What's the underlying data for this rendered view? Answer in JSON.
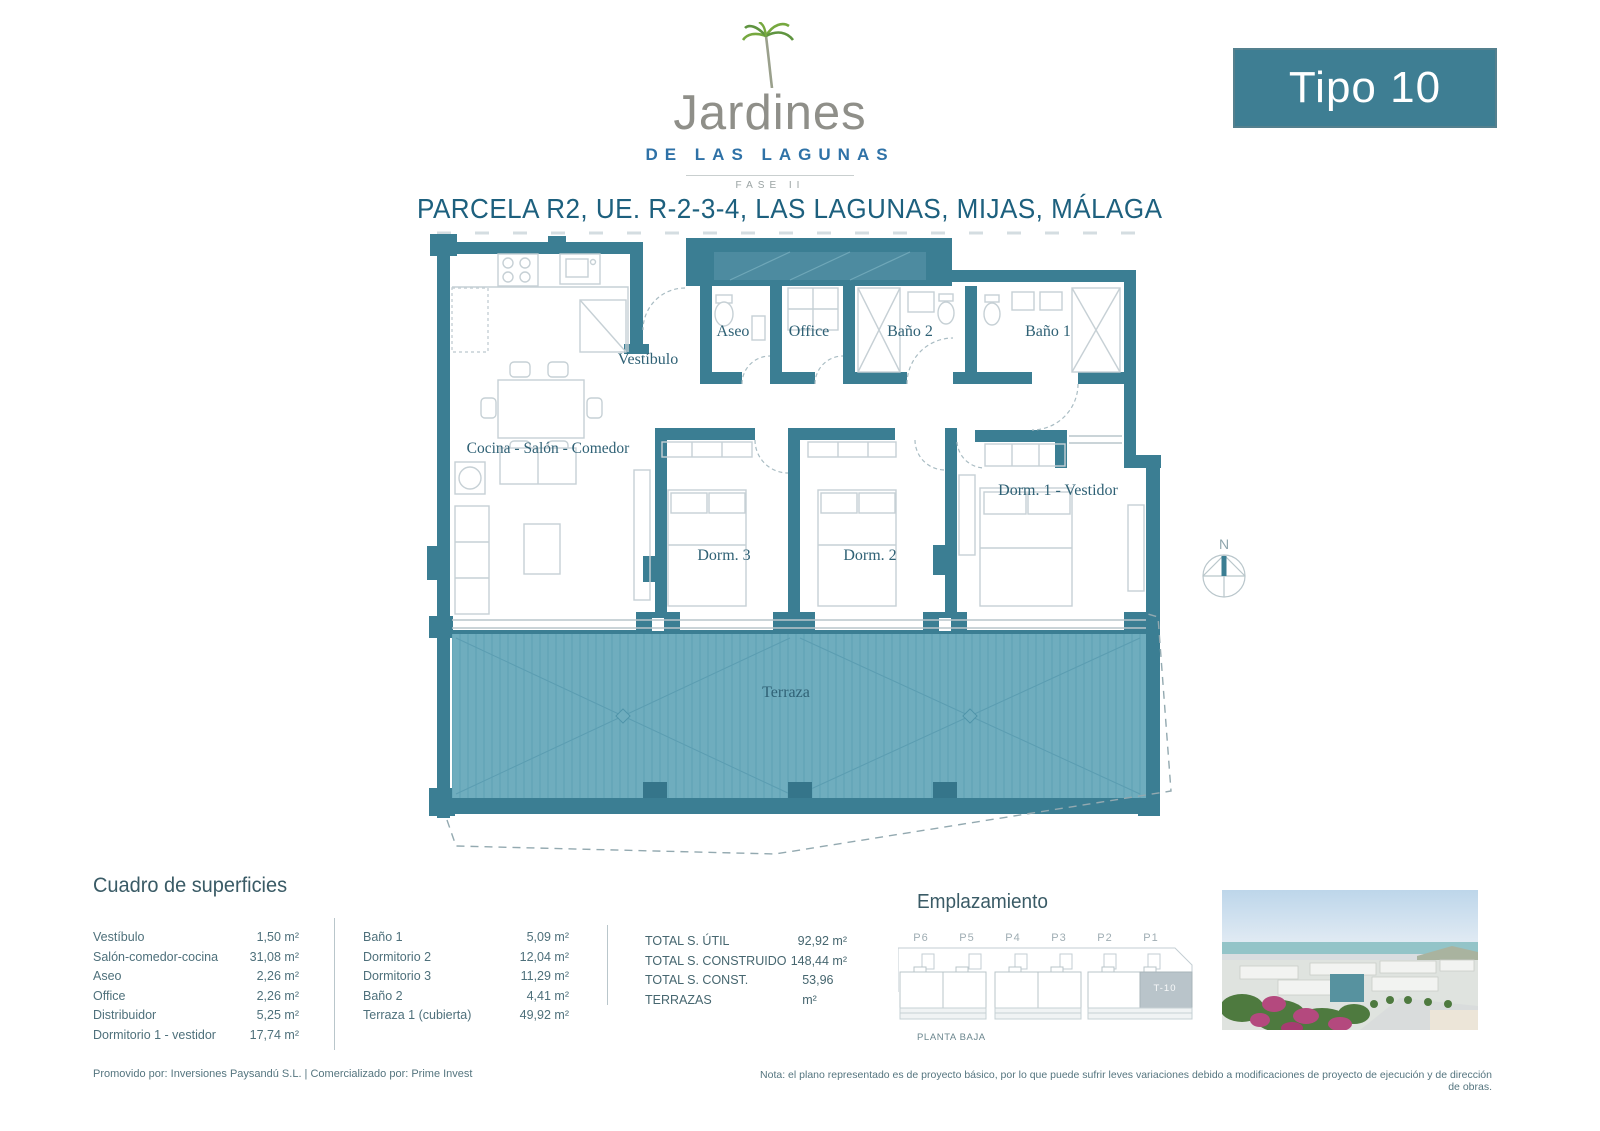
{
  "header": {
    "brand": "Jardines",
    "brand_sub": "DE LAS LAGUNAS",
    "brand_phase": "FASE II",
    "type_badge": "Tipo 10",
    "title": "PARCELA R2, UE. R-2-3-4, LAS LAGUNAS, MIJAS, MÁLAGA"
  },
  "plan": {
    "rooms": {
      "aseo": "Aseo",
      "office": "Office",
      "bano2": "Baño 2",
      "bano1": "Baño 1",
      "vestibulo": "Vestíbulo",
      "cocina": "Cocina - Salón - Comedor",
      "dorm3": "Dorm. 3",
      "dorm2": "Dorm. 2",
      "dorm1": "Dorm. 1 - Vestidor",
      "terraza": "Terraza"
    },
    "compass": "N"
  },
  "surfaces": {
    "heading": "Cuadro de superficies",
    "col1": [
      {
        "label": "Vestíbulo",
        "value": "1,50 m²"
      },
      {
        "label": "Salón-comedor-cocina",
        "value": "31,08 m²"
      },
      {
        "label": "Aseo",
        "value": "2,26 m²"
      },
      {
        "label": "Office",
        "value": "2,26 m²"
      },
      {
        "label": "Distribuidor",
        "value": "5,25 m²"
      },
      {
        "label": "Dormitorio 1 - vestidor",
        "value": "17,74 m²"
      }
    ],
    "col2": [
      {
        "label": "Baño 1",
        "value": "5,09 m²"
      },
      {
        "label": "Dormitorio 2",
        "value": "12,04 m²"
      },
      {
        "label": "Dormitorio 3",
        "value": "11,29 m²"
      },
      {
        "label": "Baño 2",
        "value": "4,41 m²"
      },
      {
        "label": "Terraza 1 (cubierta)",
        "value": "49,92 m²"
      }
    ],
    "totals": [
      {
        "label": "TOTAL S. ÚTIL",
        "value": "92,92 m²"
      },
      {
        "label": "TOTAL S. CONSTRUIDO",
        "value": "148,44 m²"
      },
      {
        "label": "TOTAL S. CONST. TERRAZAS",
        "value": "53,96 m²"
      }
    ]
  },
  "emplazamiento": {
    "heading": "Emplazamiento",
    "plots": [
      "P6",
      "P5",
      "P4",
      "P3",
      "P2",
      "P1"
    ],
    "unit_highlight": "T-10",
    "caption": "PLANTA BAJA"
  },
  "footer": {
    "promoter": "Promovido por: Inversiones Paysandú S.L.   |   Comercializado por: Prime Invest",
    "note": "Nota: el plano representado es de proyecto básico, por lo que puede sufrir leves variaciones debido a modificaciones de proyecto de ejecución y de dirección de obras."
  },
  "colors": {
    "wall_teal": "#3b7e93",
    "terrace_fill": "#6fadbe",
    "accent_dark": "#1d607e",
    "badge_teal": "#3e7e93",
    "logo_blue": "#2f72a7",
    "logo_gray": "#8f8f89"
  }
}
